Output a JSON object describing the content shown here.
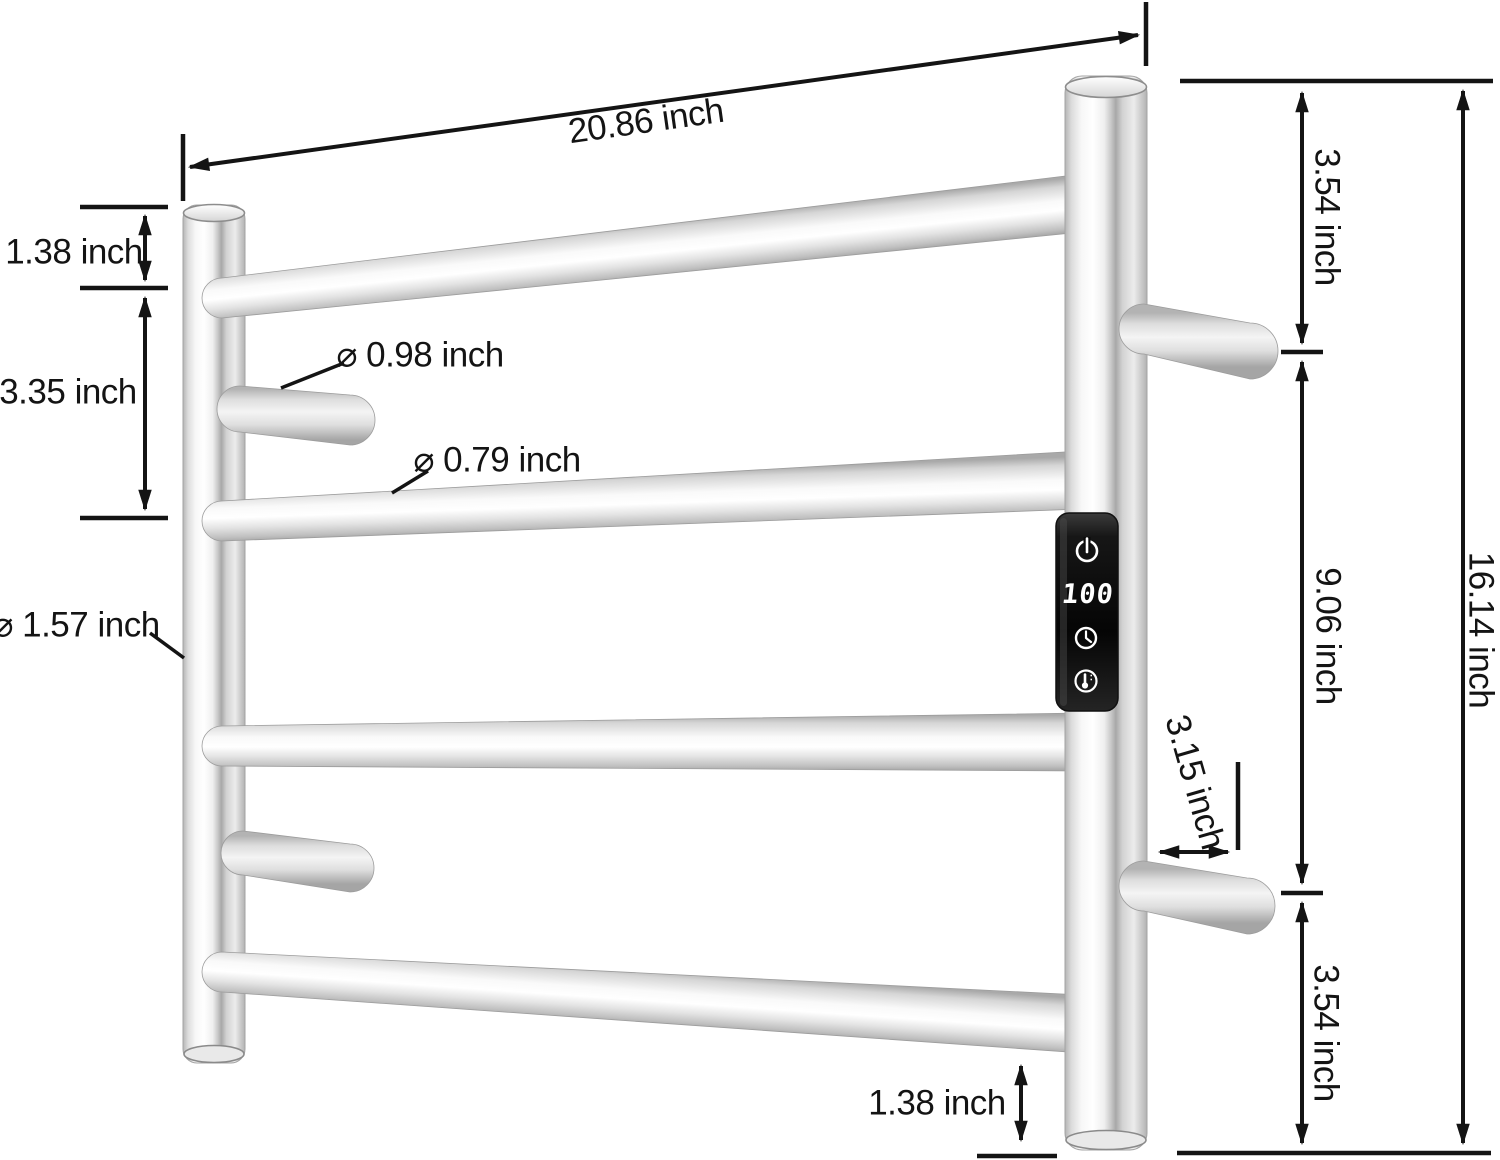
{
  "dims": {
    "width": "20.86 inch",
    "left_top_gap": "1.38 inch",
    "left_rail_gap": "3.35 inch",
    "hook_diameter": "⌀ 0.98 inch",
    "rail_diameter": "⌀ 0.79 inch",
    "post_diameter": "⌀ 1.57 inch",
    "right_top_gap": "3.54 inch",
    "right_middle_gap": "9.06 inch",
    "right_bottom_gap": "3.54 inch",
    "total_height": "16.14 inch",
    "hook_length": "3.15 inch",
    "bottom_gap": "1.38 inch"
  },
  "control_panel": {
    "display_value": "100",
    "buttons": [
      "power-icon",
      "timer-clock-icon",
      "temperature-icon"
    ]
  },
  "colors": {
    "background": "#ffffff",
    "annotation_line": "#141414",
    "metal_highlight": "#ffffff",
    "metal_shadow": "#9a9a9a",
    "panel_background": "#0a0a0a",
    "panel_glyphs": "#ffffff"
  }
}
